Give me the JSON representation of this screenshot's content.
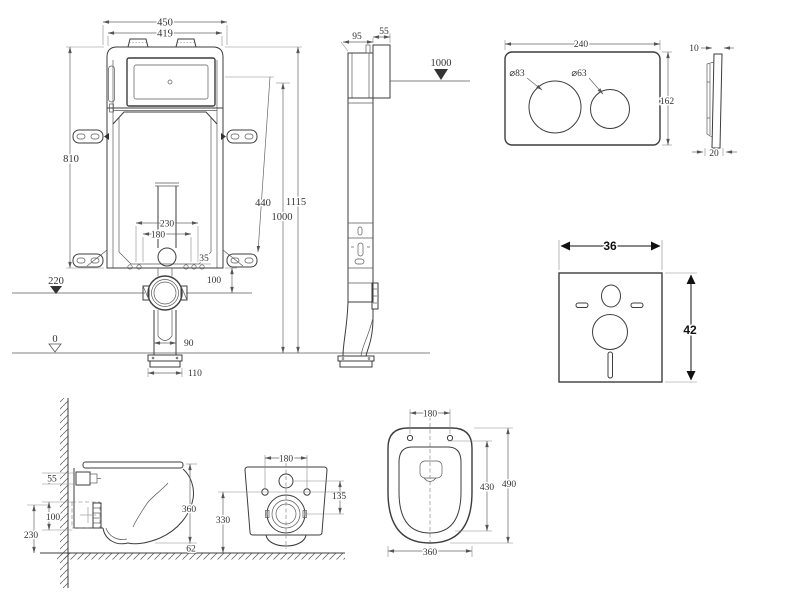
{
  "drawing": {
    "type": "technical-installation-drawing",
    "subject": "Wall-hung toilet with concealed cistern frame, flush plate, sound insulation mat and bowl dimension views"
  },
  "frame_front": {
    "width_overall": "450",
    "width_frame": "419",
    "height_frame": "810",
    "dim_440": "440",
    "dim_1115": "1115",
    "dim_1000": "1000",
    "dim_230": "230",
    "dim_180": "180",
    "dim_35": "35",
    "dim_100": "100",
    "dim_90": "90",
    "dim_110": "110",
    "level_220": "220",
    "level_0": "0"
  },
  "frame_side": {
    "depth_95": "95",
    "depth_55": "55",
    "level_1000": "1000"
  },
  "flush_plate": {
    "width": "240",
    "height": "162",
    "dia_large": "⌀83",
    "dia_small": "⌀63",
    "thickness_top": "10",
    "thickness_bottom": "20"
  },
  "sound_mat": {
    "width": "36",
    "height": "42"
  },
  "bowl_side": {
    "dim_55": "55",
    "dim_100": "100",
    "dim_230": "230",
    "dim_360": "360",
    "dim_62": "62"
  },
  "bowl_back": {
    "dim_180": "180",
    "dim_135": "135",
    "dim_330": "330"
  },
  "bowl_top": {
    "dim_180": "180",
    "dim_430": "430",
    "dim_490": "490",
    "dim_360": "360"
  }
}
